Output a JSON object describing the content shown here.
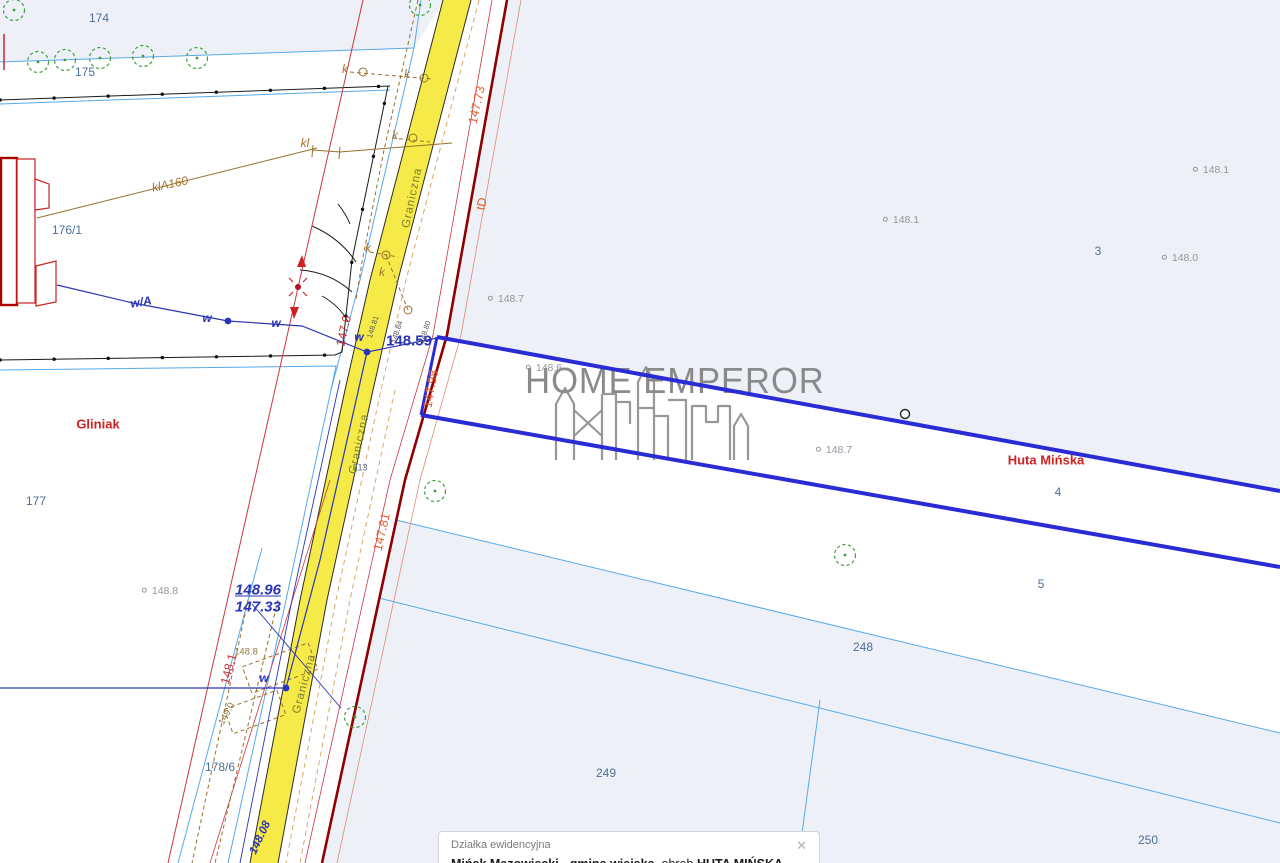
{
  "colors": {
    "road": "#f6ea48",
    "tint": "#edf1f7",
    "cyan": "#56a9ea",
    "navy": "#2a35b5",
    "red": "#cc3344",
    "darkRed": "#8f0000",
    "olive": "#96702c",
    "tan": "#d8a96a",
    "green": "#3fa03f",
    "parcelBlue": "#2b2bd6",
    "parcelNum": "#4f6d96",
    "gray": "#9296a0",
    "regionRed": "#cc2222",
    "watermark": "#8a8a8a"
  },
  "watermark": {
    "text": "HOME EMPEROR"
  },
  "infobox": {
    "title": "Działka ewidencyjna",
    "municipality": "Mińsk Mazowiecki - gmina wiejska",
    "sep1": ", obręb ",
    "district": "HUTA MIŃSKA (0017)",
    "sep2": ", numer dz.",
    "parcel": "4",
    "close_glyph": "✕"
  },
  "map": {
    "labels": [
      {
        "name": "parcel-174",
        "text": "174",
        "x": 99,
        "y": 18,
        "cls": "parcel"
      },
      {
        "name": "parcel-175",
        "text": "175",
        "x": 85,
        "y": 72,
        "cls": "parcel"
      },
      {
        "name": "parcel-176-1",
        "text": "176/1",
        "x": 67,
        "y": 230,
        "cls": "parcel"
      },
      {
        "name": "parcel-177",
        "text": "177",
        "x": 36,
        "y": 501,
        "cls": "parcel"
      },
      {
        "name": "parcel-178-6",
        "text": "178/6",
        "x": 220,
        "y": 767,
        "cls": "parcel"
      },
      {
        "name": "parcel-213",
        "text": "213",
        "x": 360,
        "y": 468,
        "cls": "parcel-sm"
      },
      {
        "name": "parcel-3",
        "text": "3",
        "x": 1098,
        "y": 251,
        "cls": "parcel"
      },
      {
        "name": "parcel-4",
        "text": "4",
        "x": 1058,
        "y": 492,
        "cls": "parcel"
      },
      {
        "name": "parcel-5",
        "text": "5",
        "x": 1041,
        "y": 584,
        "cls": "parcel"
      },
      {
        "name": "parcel-248",
        "text": "248",
        "x": 863,
        "y": 647,
        "cls": "parcel"
      },
      {
        "name": "parcel-249",
        "text": "249",
        "x": 606,
        "y": 773,
        "cls": "parcel"
      },
      {
        "name": "parcel-250",
        "text": "250",
        "x": 1148,
        "y": 840,
        "cls": "parcel"
      },
      {
        "name": "elev-148-7-a",
        "text": "148.7",
        "x": 506,
        "y": 299,
        "cls": "elev"
      },
      {
        "name": "elev-148-6",
        "text": "148.6",
        "x": 544,
        "y": 368,
        "cls": "elev"
      },
      {
        "name": "elev-148-1-a",
        "text": "148.1",
        "x": 1211,
        "y": 170,
        "cls": "elev"
      },
      {
        "name": "elev-148-1-b",
        "text": "148.1",
        "x": 901,
        "y": 220,
        "cls": "elev"
      },
      {
        "name": "elev-148-0",
        "text": "148.0",
        "x": 1180,
        "y": 258,
        "cls": "elev"
      },
      {
        "name": "elev-148-7-b",
        "text": "148.7",
        "x": 834,
        "y": 450,
        "cls": "elev"
      },
      {
        "name": "elev-148-8",
        "text": "148.8",
        "x": 160,
        "y": 591,
        "cls": "elev"
      },
      {
        "name": "region-gliniak",
        "text": "Gliniak",
        "x": 98,
        "y": 424,
        "cls": "region"
      },
      {
        "name": "region-huta-minska",
        "text": "Huta Mińska",
        "x": 1046,
        "y": 460,
        "cls": "region"
      },
      {
        "name": "street-graniczna-1",
        "text": "Graniczna",
        "x": 413,
        "y": 198,
        "rot": -78,
        "cls": "street"
      },
      {
        "name": "street-graniczna-2",
        "text": "Graniczna",
        "x": 360,
        "y": 444,
        "rot": -78,
        "cls": "street"
      },
      {
        "name": "street-graniczna-3",
        "text": "Graniczna",
        "x": 305,
        "y": 684,
        "rot": -75,
        "cls": "street"
      },
      {
        "name": "cable-k-1",
        "text": "k",
        "x": 345,
        "y": 69,
        "cls": "cable"
      },
      {
        "name": "cable-k-2",
        "text": "k",
        "x": 407,
        "y": 74,
        "cls": "cable"
      },
      {
        "name": "cable-k-3",
        "text": "k",
        "x": 395,
        "y": 135,
        "cls": "cable"
      },
      {
        "name": "cable-k-4",
        "text": "k",
        "x": 368,
        "y": 248,
        "cls": "cable"
      },
      {
        "name": "cable-k-5",
        "text": "k",
        "x": 382,
        "y": 272,
        "cls": "cable"
      },
      {
        "name": "cable-kl",
        "text": "kl",
        "x": 305,
        "y": 143,
        "cls": "cable"
      },
      {
        "name": "cable-klA160",
        "text": "klA160",
        "x": 170,
        "y": 184,
        "rot": -12,
        "cls": "cable"
      },
      {
        "name": "olive-148-8",
        "text": "148.8",
        "x": 246,
        "y": 652,
        "cls": "olive-sm"
      },
      {
        "name": "olive-149-0",
        "text": "149.0",
        "x": 227,
        "y": 714,
        "rot": -62,
        "cls": "olive-sm"
      },
      {
        "name": "water-wA",
        "text": "w/A",
        "x": 141,
        "y": 302,
        "rot": -10,
        "cls": "wlabel"
      },
      {
        "name": "water-w-1",
        "text": "w",
        "x": 207,
        "y": 318,
        "cls": "wlabel"
      },
      {
        "name": "water-w-2",
        "text": "w",
        "x": 276,
        "y": 323,
        "cls": "wlabel"
      },
      {
        "name": "water-w-3",
        "text": "w",
        "x": 359,
        "y": 337,
        "cls": "wlabel"
      },
      {
        "name": "water-w-4",
        "text": "w",
        "x": 264,
        "y": 678,
        "cls": "wlabel"
      },
      {
        "name": "survey-148-59",
        "text": "148.59",
        "x": 409,
        "y": 341,
        "cls": "survey"
      },
      {
        "name": "survey-148-96",
        "text": "148.96",
        "x": 258,
        "y": 590,
        "cls": "frac frac-top"
      },
      {
        "name": "survey-147-33",
        "text": "147.33",
        "x": 258,
        "y": 607,
        "cls": "frac"
      },
      {
        "name": "survey-148-08",
        "text": "148.08",
        "x": 261,
        "y": 838,
        "rot": -65,
        "cls": "frac-sm"
      },
      {
        "name": "roadmark-148-81",
        "text": "148.81",
        "x": 373,
        "y": 327,
        "rot": -72,
        "cls": "roadmark"
      },
      {
        "name": "roadmark-148-84",
        "text": "148.84",
        "x": 397,
        "y": 332,
        "rot": -72,
        "cls": "roadmark"
      },
      {
        "name": "roadmark-148-80",
        "text": "148.80",
        "x": 425,
        "y": 332,
        "rot": -72,
        "cls": "roadmark"
      },
      {
        "name": "meas-147-73",
        "text": "147.73",
        "x": 477,
        "y": 105,
        "rot": -77,
        "cls": "meas-o"
      },
      {
        "name": "meas-tD",
        "text": "tD",
        "x": 482,
        "y": 204,
        "rot": -77,
        "cls": "meas-o"
      },
      {
        "name": "meas-147-98",
        "text": "147.98",
        "x": 431,
        "y": 389,
        "rot": -80,
        "cls": "meas-o"
      },
      {
        "name": "meas-147-81",
        "text": "147.81",
        "x": 382,
        "y": 532,
        "rot": -77,
        "cls": "meas-o"
      },
      {
        "name": "meas-147-6",
        "text": "147.6",
        "x": 344,
        "y": 331,
        "rot": -77,
        "cls": "meas-r"
      },
      {
        "name": "meas-148-1",
        "text": "148.1",
        "x": 229,
        "y": 669,
        "rot": -75,
        "cls": "meas-r"
      }
    ]
  }
}
